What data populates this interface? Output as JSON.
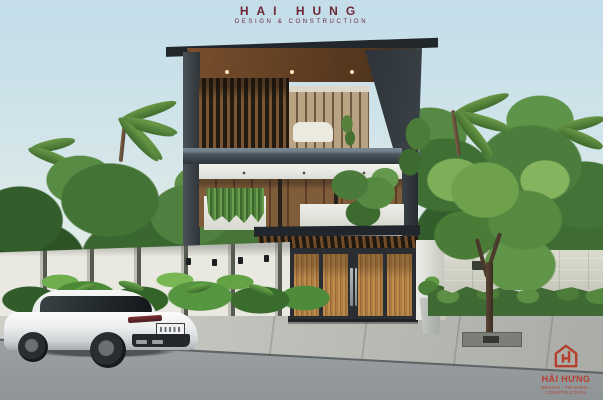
{
  "header": {
    "title": "HAI HUNG",
    "subtitle": "DESIGN & CONSTRUCTION"
  },
  "watermark": {
    "title": "HẢI HƯNG",
    "tagline": "DESIGN - TRADING - CONSTRUCTION",
    "icon": "hai-hung-house-icon"
  },
  "scene": {
    "type": "architectural-exterior-render",
    "subject": "Modern three-storey house with timber-slat facade, cantilevered dark flat roof, wooden entry gate, white perimeter fence, tropical landscaping and a white fastback car parked on the street",
    "objects": [
      "cantilevered dark flat roof with timber soffit and recessed downlights",
      "vertical timber louver screen on top floor",
      "glass facade with timber blinds and white sofa inside",
      "white fascia band with downlights",
      "timber-clad second floor wall",
      "white balcony parapet with hanging plants",
      "balcony tree",
      "slatted carport pergola",
      "four-panel timber entry gate with twin steel handles",
      "white segmented perimeter fence with black wall lamps",
      "tropical shrubs along fence",
      "palm trees and dense greenery",
      "neighbouring stone wall with ventilation slots",
      "green hedge",
      "street tree with metal grate",
      "white luxury fastback car with license plate",
      "asphalt street, concrete curb and sidewalk"
    ],
    "palette": {
      "sky": "#cfe3e9",
      "foliage": "#47783a",
      "roof_charcoal": "#23282d",
      "soffit_wood": "#6b4526",
      "facade_wood": "#7f5c3a",
      "gate_wood": "#b5854a",
      "white_surfaces": "#eceee8",
      "street": "#9ba0a2",
      "sidewalk": "#c6c6c0",
      "brand_maroon": "#6d2737",
      "brand_red": "#b5402f",
      "car_white": "#eef0f0"
    }
  }
}
